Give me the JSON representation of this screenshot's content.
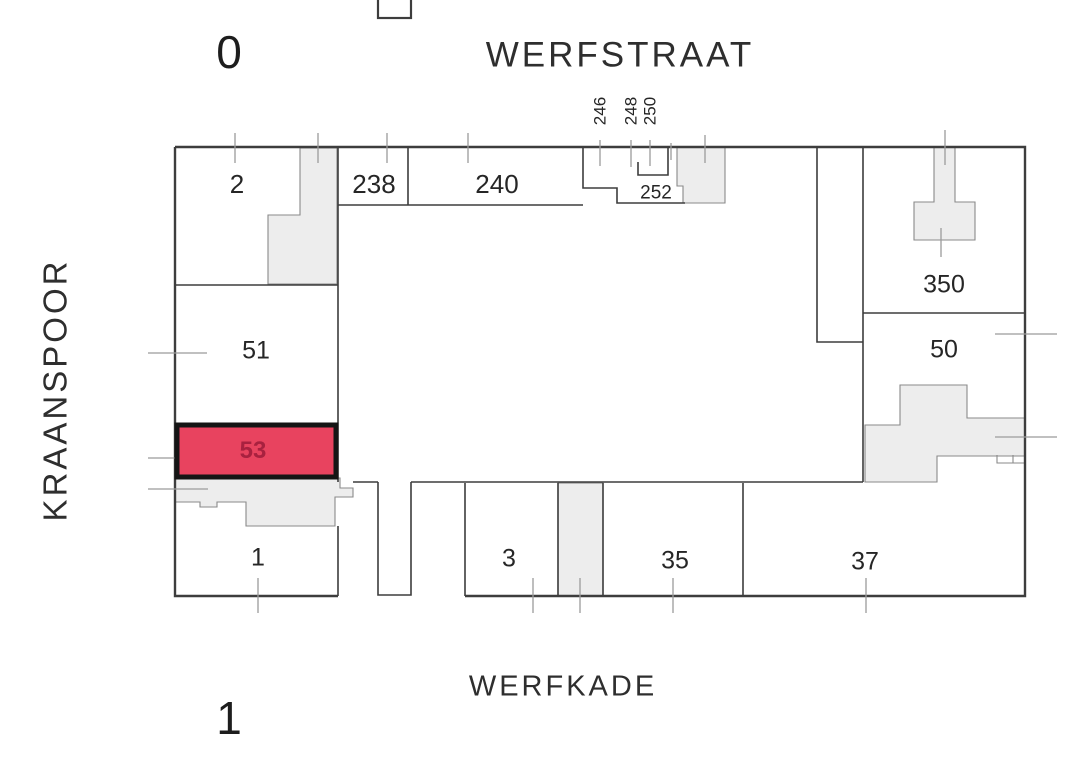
{
  "map": {
    "streets": {
      "top": "WERFSTRAAT",
      "bottom": "WERFKADE",
      "left": "KRAANSPOOR"
    },
    "floor_labels": {
      "top": "0",
      "bottom": "1"
    },
    "highlighted_parcel": "53",
    "parcels": [
      {
        "label": "2",
        "highlighted": false
      },
      {
        "label": "238",
        "highlighted": false
      },
      {
        "label": "240",
        "highlighted": false
      },
      {
        "label": "246",
        "highlighted": false
      },
      {
        "label": "248",
        "highlighted": false
      },
      {
        "label": "250",
        "highlighted": false
      },
      {
        "label": "252",
        "highlighted": false
      },
      {
        "label": "51",
        "highlighted": false
      },
      {
        "label": "53",
        "highlighted": true
      },
      {
        "label": "1",
        "highlighted": false
      },
      {
        "label": "3",
        "highlighted": false
      },
      {
        "label": "35",
        "highlighted": false
      },
      {
        "label": "37",
        "highlighted": false
      },
      {
        "label": "350",
        "highlighted": false
      },
      {
        "label": "50",
        "highlighted": false
      }
    ],
    "colors": {
      "highlight_fill": "#e8435f",
      "highlight_text": "#a8213f",
      "highlight_border": "#151515",
      "building_fill": "#ededed",
      "building_stroke": "#8a8a8a",
      "line": "#3d3d3d",
      "tick": "#9b9b9b",
      "background": "#ffffff",
      "text": "#2b2b2b"
    }
  }
}
